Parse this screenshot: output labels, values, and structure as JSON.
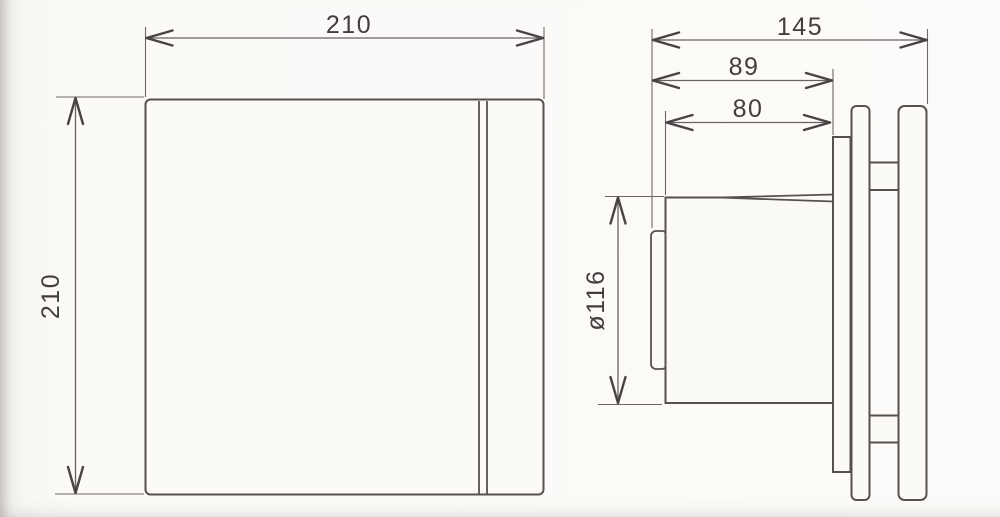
{
  "drawing": {
    "kind": "technical-dimension-drawing",
    "subject": "extractor fan — front view and side view",
    "front_view": {
      "width_label": "210",
      "height_label": "210"
    },
    "side_view": {
      "overall_depth_label": "145",
      "depth_to_plate_label": "89",
      "duct_length_label": "80",
      "duct_diameter_label": "ø116"
    },
    "colors": {
      "line": "#57504f",
      "dimension_line": "#6a6263",
      "text": "#433d3e",
      "paper": "#fbfaf7"
    }
  }
}
